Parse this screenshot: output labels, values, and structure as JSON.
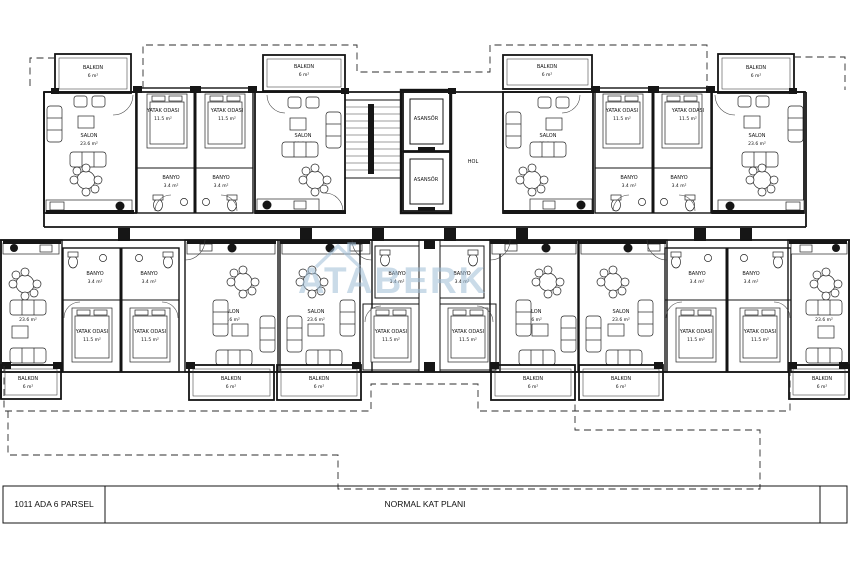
{
  "drawing": {
    "title_block": {
      "parcel_label": "1011 ADA  6 PARSEL",
      "plan_title": "NORMAL KAT PLANI"
    },
    "watermark": {
      "text": "ATABERK",
      "color": "#9fbed7"
    },
    "rooms": {
      "balkon": {
        "name": "BALKON",
        "area": "6 m²"
      },
      "salon": {
        "name": "SALON",
        "area": "23.6 m²"
      },
      "yatak_odasi": {
        "name": "YATAK ODASI",
        "area": "11.5 m²"
      },
      "banyo": {
        "name": "BANYO",
        "area": "3.4 m²"
      },
      "asansor": {
        "name": "ASANSÖR"
      },
      "hol": {
        "name": "HOL"
      }
    },
    "colors": {
      "line": "#141414",
      "watermark": "#9fbed7"
    }
  }
}
